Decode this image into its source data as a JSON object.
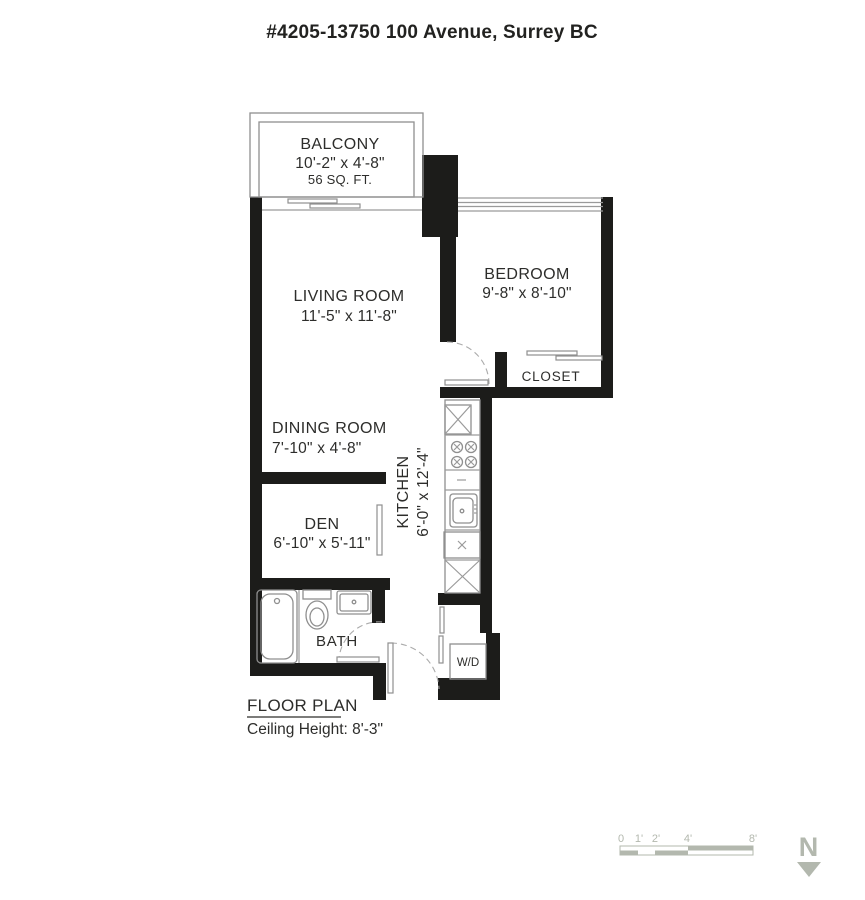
{
  "title": "#4205-13750 100 Avenue, Surrey BC",
  "rooms": {
    "balcony": {
      "name": "BALCONY",
      "dims": "10'-2\" x 4'-8\"",
      "area": "56 SQ. FT."
    },
    "living_room": {
      "name": "LIVING ROOM",
      "dims": "11'-5\" x 11'-8\""
    },
    "bedroom": {
      "name": "BEDROOM",
      "dims": "9'-8\" x 8'-10\""
    },
    "closet": {
      "name": "CLOSET"
    },
    "dining_room": {
      "name": "DINING ROOM",
      "dims": "7'-10\" x 4'-8\""
    },
    "kitchen": {
      "name": "KITCHEN",
      "dims": "6'-0\" x 12'-4\""
    },
    "den": {
      "name": "DEN",
      "dims": "6'-10\" x 5'-11\""
    },
    "bath": {
      "name": "BATH"
    },
    "laundry": {
      "name": "W/D"
    }
  },
  "footer": {
    "plan_label": "FLOOR PLAN",
    "ceiling_height": "Ceiling Height: 8'-3\""
  },
  "scale_bar": {
    "ticks": [
      "0",
      "1'",
      "2'",
      "4'",
      "8'"
    ]
  },
  "compass": {
    "north_label": "N"
  },
  "colors": {
    "wall": "#1c1c1a",
    "fixture_line": "#8f8f8f",
    "text": "#2d2d2b",
    "scale": "#b3b8ae"
  }
}
